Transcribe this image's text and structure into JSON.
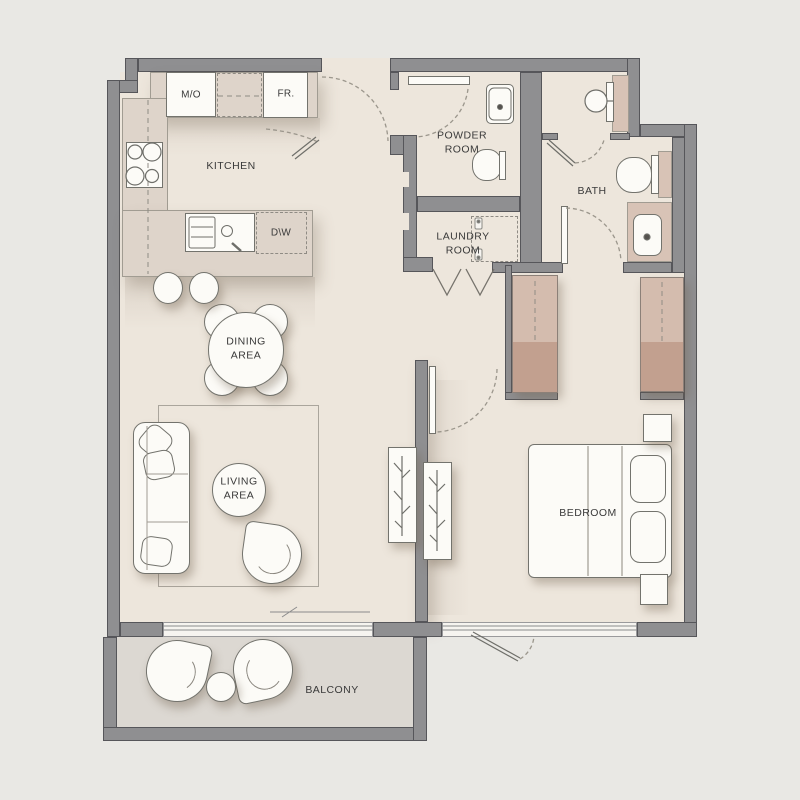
{
  "rooms": {
    "kitchen": "KITCHEN",
    "powder": "POWDER\nROOM",
    "bath": "BATH",
    "laundry": "LAUNDRY\nROOM",
    "dining": "DINING\nAREA",
    "living": "LIVING\nAREA",
    "bedroom": "BEDROOM",
    "balcony": "BALCONY"
  },
  "appliances": {
    "microwave_oven": "M/O",
    "fridge": "FR.",
    "dishwasher": "D\\W"
  },
  "colors": {
    "background": "#e9e8e4",
    "floor": "#ede6dc",
    "balcony_floor": "#dcd8d2",
    "wall": "#8f8f91",
    "wall_outline": "#56565a",
    "counter": "#ded4ca",
    "counter_outline": "#a19c92",
    "fixture": "#fcfbf7",
    "fixture_outline": "#73736d",
    "wardrobe_top": "#d4bcae",
    "wardrobe_bottom": "#c2a08f",
    "accent_tan": "#d8c3b6",
    "line": "#8f8b84",
    "text": "#3a3a3a"
  }
}
